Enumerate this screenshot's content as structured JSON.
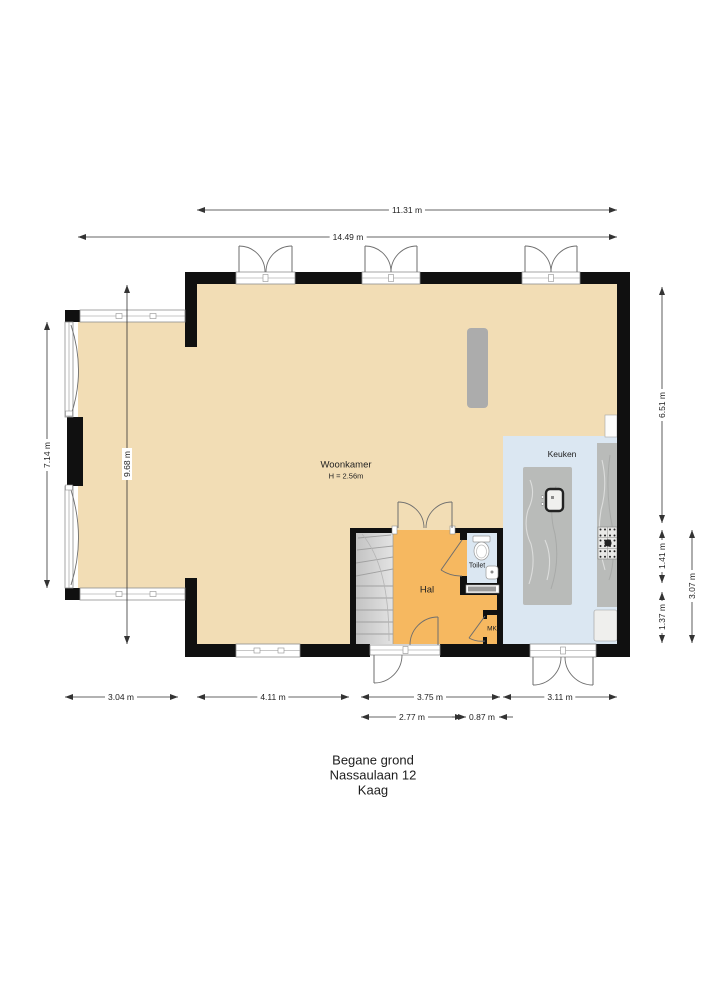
{
  "title": {
    "line1": "Begane grond",
    "line2": "Nassaulaan 12",
    "line3": "Kaag"
  },
  "rooms": {
    "woonkamer": {
      "name": "Woonkamer",
      "height_note": "H = 2.56m"
    },
    "keuken": {
      "name": "Keuken"
    },
    "hal": {
      "name": "Hal"
    },
    "toilet": {
      "name": "Toilet"
    },
    "mk": {
      "name": "MK"
    }
  },
  "dimensions": {
    "top_inner": "11.31 m",
    "top_outer": "14.49 m",
    "left_inner": "7.14 m",
    "left_outer": "9.68 m",
    "right_upper": "6.51 m",
    "right_mid": "1.41 m",
    "right_lower": "1.37 m",
    "right_outer": "3.07 m",
    "bottom_extension": "3.04 m",
    "bottom_livingroom": "4.11 m",
    "bottom_hall_outer": "3.75 m",
    "bottom_kitchen": "3.11 m",
    "bottom_hall_inner": "2.77 m",
    "bottom_toilet": "0.87 m"
  },
  "colors": {
    "c-wall": "#101010",
    "c-floor": "#F2DDB5",
    "c-hall": "#F6B860",
    "c-kitchen": "#DBE7F2",
    "c-stairs": "#D2D2D2",
    "c-counter": "#B9BBB9",
    "c-dim": "#333333"
  }
}
